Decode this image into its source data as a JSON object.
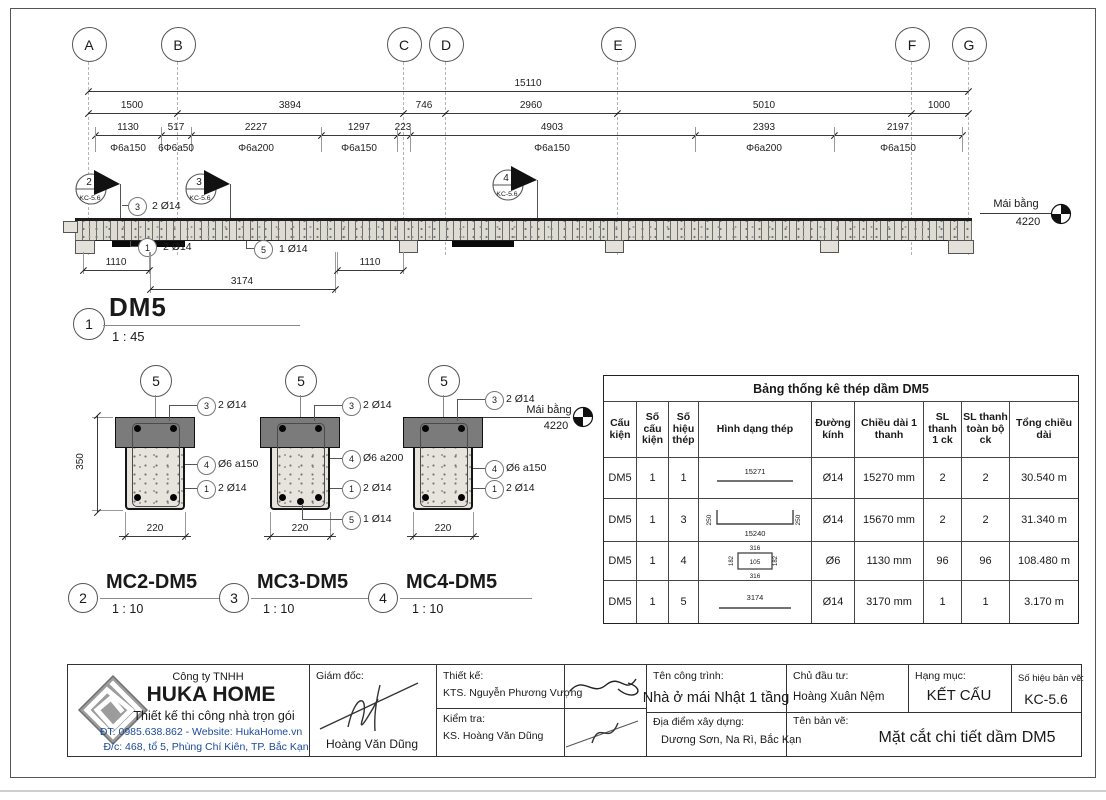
{
  "grid": {
    "labels": [
      "A",
      "B",
      "C",
      "D",
      "E",
      "F",
      "G"
    ]
  },
  "dims": {
    "total": "15110",
    "row2": [
      "1500",
      "3894",
      "746",
      "2960",
      "5010",
      "1000"
    ],
    "row3": [
      "1130",
      "517",
      "2227",
      "1297",
      "223",
      "4903",
      "2393",
      "2197"
    ],
    "stirrups": [
      "Φ6a150",
      "6Φ6a50",
      "Φ6a200",
      "Φ6a150",
      "Φ6a150",
      "Φ6a200",
      "Φ6a150"
    ],
    "below": [
      "1110",
      "3174",
      "1110"
    ]
  },
  "flags": {
    "ref": "KC-5.6",
    "numbers": [
      "2",
      "3",
      "4"
    ]
  },
  "elev_callouts": [
    {
      "n": "3",
      "t": "2 Ø14"
    },
    {
      "n": "1",
      "t": "2 Ø14"
    },
    {
      "n": "5",
      "t": "1 Ø14"
    }
  ],
  "level": {
    "name": "Mái bằng",
    "value": "4220"
  },
  "view": {
    "num": "1",
    "name": "DM5",
    "scale": "1 : 45"
  },
  "sections": [
    {
      "num": "2",
      "name": "MC2-DM5",
      "scale": "1 : 10",
      "cut": "5",
      "w": "220",
      "h": "350",
      "callouts": [
        {
          "n": "3",
          "t": "2 Ø14"
        },
        {
          "n": "4",
          "t": "Ø6 a150"
        },
        {
          "n": "1",
          "t": "2 Ø14"
        }
      ]
    },
    {
      "num": "3",
      "name": "MC3-DM5",
      "scale": "1 : 10",
      "cut": "5",
      "w": "220",
      "callouts": [
        {
          "n": "3",
          "t": "2 Ø14"
        },
        {
          "n": "4",
          "t": "Ø6 a200"
        },
        {
          "n": "1",
          "t": "2 Ø14"
        },
        {
          "n": "5",
          "t": "1 Ø14"
        }
      ]
    },
    {
      "num": "4",
      "name": "MC4-DM5",
      "scale": "1 : 10",
      "cut": "5",
      "w": "220",
      "callouts": [
        {
          "n": "3",
          "t": "2 Ø14"
        },
        {
          "n": "4",
          "t": "Ø6 a150"
        },
        {
          "n": "1",
          "t": "2 Ø14"
        }
      ]
    }
  ],
  "table": {
    "title": "Bảng thống kê thép dầm DM5",
    "headers": [
      "Cấu kiện",
      "Số cấu kiện",
      "Số hiệu thép",
      "Hình dạng thép",
      "Đường kính",
      "Chiều dài 1 thanh",
      "SL thanh 1 ck",
      "SL thanh toàn bộ ck",
      "Tổng chiều dài"
    ],
    "rows": [
      {
        "member": "DM5",
        "count": "1",
        "mark": "1",
        "dia": "Ø14",
        "length": "15270 mm",
        "qty_1ck": "2",
        "qty_all": "2",
        "total": "30.540 m",
        "shape": {
          "type": "line",
          "label": "15271"
        }
      },
      {
        "member": "DM5",
        "count": "1",
        "mark": "3",
        "dia": "Ø14",
        "length": "15670 mm",
        "qty_1ck": "2",
        "qty_all": "2",
        "total": "31.340 m",
        "shape": {
          "type": "u-bar",
          "label": "15240",
          "end": "250"
        }
      },
      {
        "member": "DM5",
        "count": "1",
        "mark": "4",
        "dia": "Ø6",
        "length": "1130 mm",
        "qty_1ck": "96",
        "qty_all": "96",
        "total": "108.480 m",
        "shape": {
          "type": "stirrup",
          "top": "316",
          "bottom": "316",
          "side": "182",
          "inner": "105"
        }
      },
      {
        "member": "DM5",
        "count": "1",
        "mark": "5",
        "dia": "Ø14",
        "length": "3170 mm",
        "qty_1ck": "1",
        "qty_all": "1",
        "total": "3.170 m",
        "shape": {
          "type": "line",
          "label": "3174"
        }
      }
    ]
  },
  "titleblock": {
    "company_type": "Công ty TNHH",
    "company": "HUKA HOME",
    "slogan": "Thiết kế thi công nhà trọn gói",
    "contact": "ĐT: 0985.638.862 - Website: HukaHome.vn",
    "address": "Đ/c: 468, tổ 5, Phùng Chí Kiên, TP. Bắc Kạn",
    "director_label": "Giám đốc:",
    "director": "Hoàng Văn Dũng",
    "design_label": "Thiết kế:",
    "designer": "KTS. Nguyễn Phương Vượng",
    "check_label": "Kiểm tra:",
    "checker": "KS. Hoàng Văn Dũng",
    "project_label": "Tên công trình:",
    "project": "Nhà ở mái Nhật 1 tầng",
    "owner_label": "Chủ đầu tư:",
    "owner": "Hoàng Xuân Nệm",
    "category_label": "Hạng mục:",
    "category": "KẾT CẤU",
    "sheet_label": "Số hiệu bản vẽ:",
    "sheet": "KC-5.6",
    "location_label": "Địa điểm xây dựng:",
    "location": "Dương Sơn, Na Rì, Bắc Kạn",
    "drawing_label": "Tên bản vẽ:",
    "drawing_name": "Mặt cắt chi tiết dầm DM5"
  },
  "colors": {
    "contact_blue": "#1b4a9b",
    "slab_gray": "#7b7b7b",
    "logo_gray": "#9c9c9c"
  }
}
